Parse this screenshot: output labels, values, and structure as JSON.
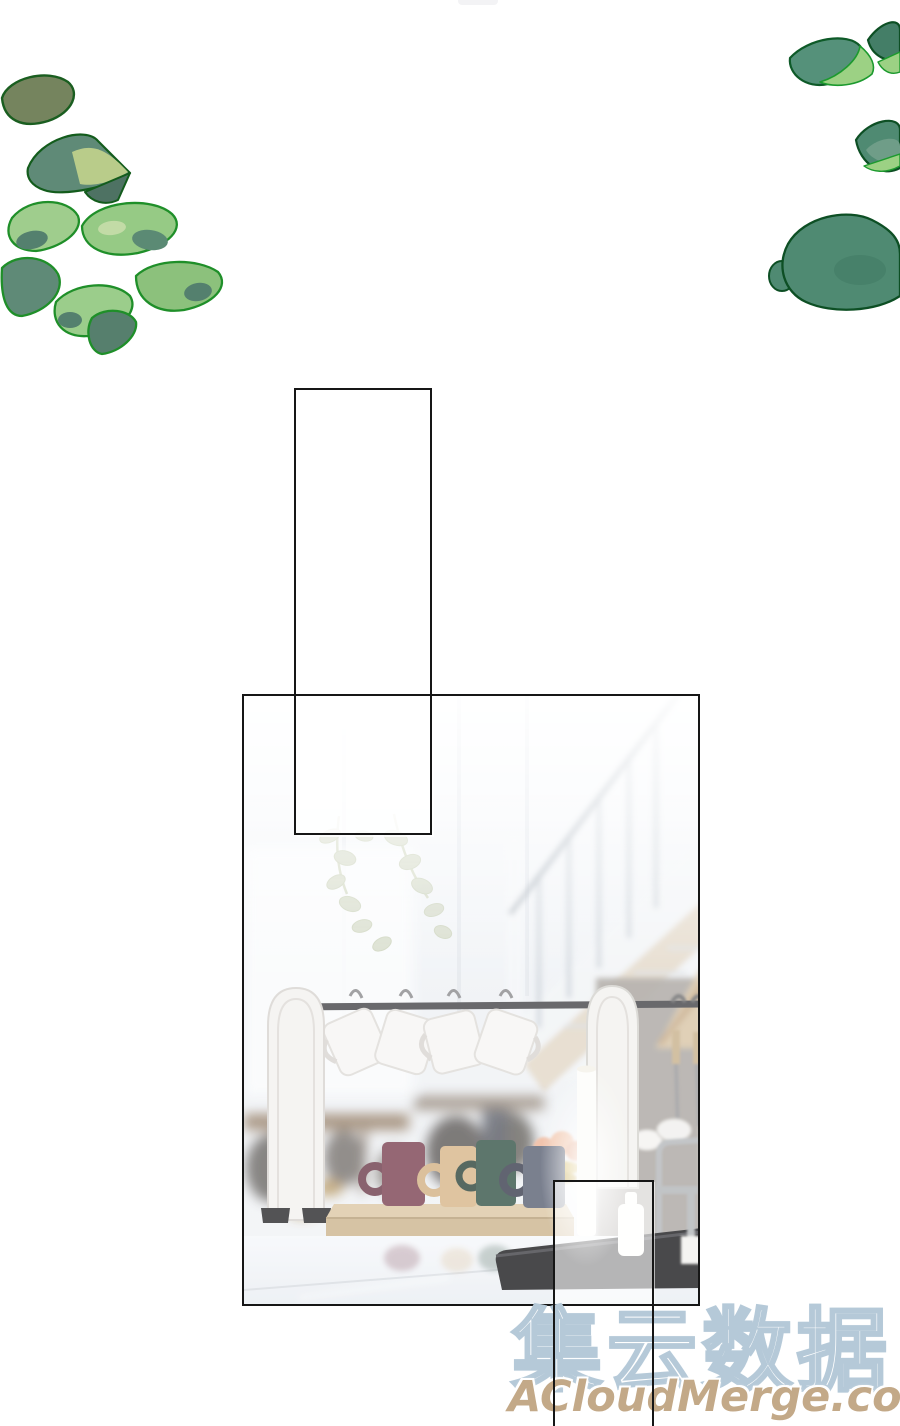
{
  "page": {
    "kind": "comic-page",
    "background": "#ffffff",
    "panel_border_color": "#161616"
  },
  "watermark": {
    "brand_text": "集云数据",
    "brand_fill": "#ffffff",
    "brand_outline": "#b5c9d8",
    "site_text": "ACloudMerge.com",
    "site_color": "#c3a988"
  },
  "scene": {
    "palette": {
      "bg_light": "#f1f4f7",
      "wall_gray": "#a8a39d",
      "wood_tray_top": "#ddc9a6",
      "wood_tray_front": "#cdb691",
      "stair_rail": "#98a3ad",
      "stair_stringer": "#dbc9ae",
      "rack_bar": "#48484c",
      "rack_arch": "#f3f2ef",
      "mug_white": "#f7f6f4",
      "mug_maroon": "#7e4656",
      "mug_tan": "#d8b88c",
      "mug_green": "#3a584c",
      "mug_navy": "#5d6476",
      "cooktop_black": "#212124",
      "plant_sage": "#ccd3bc",
      "peach": "#eeb79b",
      "candle_white": "#fdfdfa",
      "counter_white": "#f3f6f9",
      "table_wood": "#8a7157"
    }
  },
  "decorations": {
    "foliage_left": {
      "olive": "#75845e",
      "light_green": "#9fcd8d",
      "teal_green": "#5f8a77",
      "yellow_green": "#b9cc8a",
      "outline": "#1f8f29"
    },
    "foliage_right": {
      "teal": "#55917a",
      "deep_teal": "#4f8a72",
      "highlight": "#9cd184",
      "outline": "#0d5226"
    }
  }
}
